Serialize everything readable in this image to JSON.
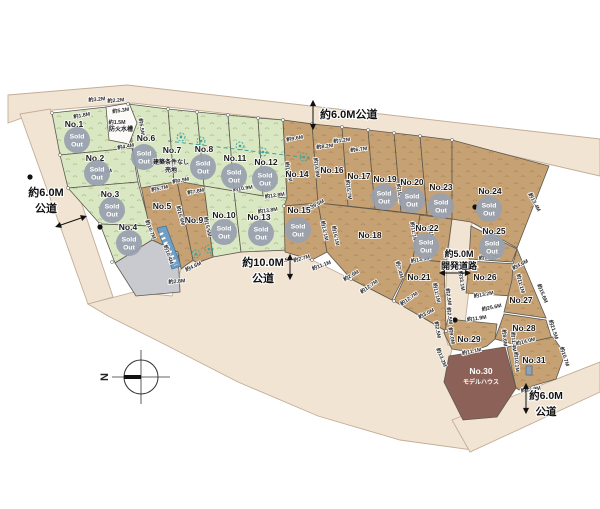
{
  "colors": {
    "road": "#f2e4d3",
    "road_stroke": "#c3ad96",
    "green": "#d9e7c2",
    "green_mark": "#a4bd81",
    "brown": "#c6a173",
    "brown_mark": "#a8854e",
    "maroon": "#8c6157",
    "gray": "#c9cad0",
    "white_lot": "#fbfaf6",
    "plot_stroke": "#5d594f",
    "badge": "#98a1af",
    "badge_text": "#ffffff",
    "dim_text": "#2a2a2a",
    "label_text": "#1a1a1a",
    "tree": "#3aa69f",
    "strip": "#6f9fc4",
    "strip_stroke": "#46749c",
    "road_label_text": "#111111",
    "dash_line": "#2f9e97"
  },
  "sold_badge": {
    "line1": "Sold",
    "line2": "Out"
  },
  "roads": [
    {
      "name": "top-road",
      "pts": "8,95 127,85 600,139 600,176 452,142 283,120 133,103 42,111 8,123"
    },
    {
      "name": "left-road",
      "pts": "20,114 50,109 113,297 88,304"
    },
    {
      "name": "bottom-curved-road",
      "pts": "88,304 134,292 172,296 182,266 198,259 241,252 288,250 312,260 351,279 394,301 446,331 444,333 452,349 444,382 463,420 472,450 400,440 318,416 238,382 160,342 108,316"
    },
    {
      "name": "bottom-right-road",
      "pts": "452,420 600,362 600,392 470,452"
    },
    {
      "name": "development-road",
      "pts": "452,219 472,222 469,290 462,348 448,345 444,331 447,262"
    }
  ],
  "plots": [
    {
      "id": "No.1",
      "pts": "52,113 125,105 132,148 60,155",
      "fill": "green",
      "label": {
        "t": "No.1",
        "x": 74,
        "y": 127
      },
      "badge": {
        "x": 77,
        "y": 140
      }
    },
    {
      "id": "No.2",
      "pts": "60,155 132,148 138,182 68,188",
      "fill": "green",
      "label": {
        "t": "No.2",
        "x": 95,
        "y": 161
      },
      "badge": {
        "x": 97,
        "y": 173
      }
    },
    {
      "id": "No.3",
      "pts": "68,188 138,182 150,226 100,224",
      "fill": "green",
      "label": {
        "t": "No.3",
        "x": 110,
        "y": 197
      },
      "badge": {
        "x": 112,
        "y": 210
      }
    },
    {
      "id": "No.4",
      "pts": "100,224 150,226 152,240 115,263",
      "fill": "green",
      "label": {
        "t": "No.4",
        "x": 128,
        "y": 230
      },
      "badge": {
        "x": 129,
        "y": 243
      }
    },
    {
      "id": "No.5",
      "pts": "141,186 177,181 193,260 181,269 178,252 152,240",
      "fill": "brown",
      "label": {
        "t": "No.5",
        "x": 162,
        "y": 209
      }
    },
    {
      "id": "No.6",
      "pts": "128,104 168,109 174,182 141,188 133,150",
      "fill": "green",
      "label": {
        "t": "No.6",
        "x": 146,
        "y": 141
      },
      "badge": {
        "x": 144,
        "y": 157
      }
    },
    {
      "id": "No.7",
      "pts": "168,109 197,112 204,186 174,182",
      "fill": "green",
      "label": {
        "t": "No.7",
        "x": 172,
        "y": 153
      },
      "sub": [
        {
          "t": "建築条件なし",
          "x": 171,
          "y": 164
        },
        {
          "t": "売地",
          "x": 171,
          "y": 172
        }
      ]
    },
    {
      "id": "No.8",
      "pts": "197,112 228,115 234,191 204,186",
      "fill": "green",
      "label": {
        "t": "No.8",
        "x": 204,
        "y": 152
      },
      "badge": {
        "x": 203,
        "y": 167
      }
    },
    {
      "id": "No.9",
      "pts": "177,181 204,186 213,257 197,263 193,260",
      "fill": "brown",
      "label": {
        "t": "No.9",
        "x": 194,
        "y": 223
      }
    },
    {
      "id": "No.10",
      "pts": "204,186 234,191 241,252 213,257",
      "fill": "green",
      "label": {
        "t": "No.10",
        "x": 224,
        "y": 218
      },
      "badge": {
        "x": 224,
        "y": 232
      }
    },
    {
      "id": "No.11",
      "pts": "228,115 258,118 263,196 234,191",
      "fill": "green",
      "label": {
        "t": "No.11",
        "x": 235,
        "y": 161
      },
      "badge": {
        "x": 234,
        "y": 176
      }
    },
    {
      "id": "No.12",
      "pts": "258,118 283,120 287,198 263,196",
      "fill": "green",
      "label": {
        "t": "No.12",
        "x": 266,
        "y": 165
      },
      "badge": {
        "x": 265,
        "y": 179
      }
    },
    {
      "id": "No.13",
      "pts": "234,191 263,196 287,198 288,250 241,252",
      "fill": "green",
      "label": {
        "t": "No.13",
        "x": 259,
        "y": 220
      },
      "badge": {
        "x": 261,
        "y": 233
      }
    },
    {
      "id": "No.14",
      "pts": "283,120 312,124 318,203 284,206 287,198",
      "fill": "brown",
      "label": {
        "t": "No.14",
        "x": 297,
        "y": 177
      }
    },
    {
      "id": "No.15",
      "pts": "284,206 318,203 327,252 312,260 285,252",
      "fill": "brown",
      "label": {
        "t": "No.15",
        "x": 299,
        "y": 213
      },
      "badge": {
        "x": 298,
        "y": 230
      }
    },
    {
      "id": "No.16",
      "pts": "312,124 342,127 348,206 318,203",
      "fill": "brown",
      "label": {
        "t": "No.16",
        "x": 332,
        "y": 173
      }
    },
    {
      "id": "No.17",
      "pts": "342,127 368,130 375,209 348,206",
      "fill": "brown",
      "label": {
        "t": "No.17",
        "x": 359,
        "y": 179
      }
    },
    {
      "id": "No.18",
      "pts": "318,203 424,215 413,259 392,300 351,279 327,252",
      "fill": "brown",
      "label": {
        "t": "No.18",
        "x": 370,
        "y": 238
      }
    },
    {
      "id": "No.19",
      "pts": "368,130 394,133 401,212 375,209",
      "fill": "brown",
      "label": {
        "t": "No.19",
        "x": 385,
        "y": 182
      },
      "badge": {
        "x": 384,
        "y": 197
      }
    },
    {
      "id": "No.20",
      "pts": "394,133 420,136 427,215 401,212",
      "fill": "brown",
      "label": {
        "t": "No.20",
        "x": 412,
        "y": 185
      },
      "badge": {
        "x": 412,
        "y": 200
      }
    },
    {
      "id": "No.21",
      "pts": "413,259 444,262 446,331 394,301",
      "fill": "brown",
      "label": {
        "t": "No.21",
        "x": 419,
        "y": 280
      }
    },
    {
      "id": "No.22",
      "pts": "420,215 452,219 446,262 413,259",
      "fill": "brown",
      "label": {
        "t": "No.22",
        "x": 427,
        "y": 231
      },
      "badge": {
        "x": 426,
        "y": 246
      }
    },
    {
      "id": "No.23",
      "pts": "420,136 452,140 452,219 427,215",
      "fill": "brown",
      "label": {
        "t": "No.23",
        "x": 441,
        "y": 190
      },
      "badge": {
        "x": 441,
        "y": 206
      }
    },
    {
      "id": "No.24",
      "pts": "452,140 549,166 517,248 471,222 452,219",
      "fill": "brown",
      "label": {
        "t": "No.24",
        "x": 490,
        "y": 194
      },
      "badge": {
        "x": 489,
        "y": 209
      }
    },
    {
      "id": "No.25",
      "pts": "471,226 517,249 512,262 469,259",
      "fill": "brown",
      "label": {
        "t": "No.25",
        "x": 494,
        "y": 234
      },
      "badge": {
        "x": 492,
        "y": 247
      }
    },
    {
      "id": "No.26",
      "pts": "469,261 517,264 512,296 466,293",
      "fill": "brown",
      "label": {
        "t": "No.26",
        "x": 485,
        "y": 280
      }
    },
    {
      "id": "No.27",
      "pts": "517,249 546,318 504,312 512,280 513,264",
      "fill": "brown",
      "label": {
        "t": "No.27",
        "x": 521,
        "y": 303
      }
    },
    {
      "id": "No.28",
      "pts": "504,314 546,320 556,352 516,345 495,339",
      "fill": "brown",
      "label": {
        "t": "No.28",
        "x": 524,
        "y": 331
      }
    },
    {
      "id": "No.29",
      "pts": "448,319 497,324 495,339 487,346 470,352 452,349 444,333",
      "fill": "brown",
      "label": {
        "t": "No.29",
        "x": 469,
        "y": 342
      }
    },
    {
      "id": "No.30",
      "pts": "449,356 505,347 516,388 497,417 463,420 444,382",
      "fill": "maroon",
      "label": {
        "t": "No.30",
        "x": 481,
        "y": 374,
        "white": true
      },
      "sub": [
        {
          "t": "モデルハウス",
          "x": 481,
          "y": 384,
          "white": true
        }
      ]
    },
    {
      "id": "No.31",
      "pts": "507,347 553,337 565,354 556,379 519,390 516,388",
      "fill": "brown",
      "label": {
        "t": "No.31",
        "x": 534,
        "y": 363
      }
    },
    {
      "id": "gray-lot",
      "pts": "115,263 152,240 178,252 180,292 136,296",
      "fill": "gray"
    },
    {
      "id": "fire-cistern",
      "pts": "106,107 129,103 137,123 129,144 109,140",
      "fill": "white_lot",
      "sub": [
        {
          "t": "防火水槽",
          "x": 121,
          "y": 131
        }
      ]
    }
  ],
  "dimensions": [
    {
      "t": "約3.2M",
      "x": 97,
      "y": 101,
      "r": -5
    },
    {
      "t": "約2.2M",
      "x": 116,
      "y": 102,
      "r": -5
    },
    {
      "t": "約1.8M",
      "x": 82,
      "y": 117,
      "r": -10
    },
    {
      "t": "約5.3M",
      "x": 121,
      "y": 112,
      "r": -8
    },
    {
      "t": "約1.5M",
      "x": 117,
      "y": 124,
      "r": 0
    },
    {
      "t": "約4.4M",
      "x": 126,
      "y": 148,
      "r": -10
    },
    {
      "t": "約5.5M",
      "x": 140,
      "y": 127,
      "r": 82
    },
    {
      "t": "約4.9M",
      "x": 104,
      "y": 174,
      "r": -14
    },
    {
      "t": "約5.7M",
      "x": 160,
      "y": 190,
      "r": -12
    },
    {
      "t": "約7.8M",
      "x": 196,
      "y": 193,
      "r": -10
    },
    {
      "t": "約0.9M",
      "x": 181,
      "y": 182,
      "r": -10
    },
    {
      "t": "約10.9M",
      "x": 243,
      "y": 190,
      "r": -8
    },
    {
      "t": "約12.8M",
      "x": 275,
      "y": 197,
      "r": -8
    },
    {
      "t": "約13.8M",
      "x": 268,
      "y": 212,
      "r": -8
    },
    {
      "t": "約15.9M",
      "x": 179,
      "y": 216,
      "r": 75
    },
    {
      "t": "約15.5M",
      "x": 206,
      "y": 227,
      "r": 78
    },
    {
      "t": "約10.7M",
      "x": 149,
      "y": 230,
      "r": 68
    },
    {
      "t": "約10.4M",
      "x": 167,
      "y": 255,
      "r": 70
    },
    {
      "t": "約4.6M",
      "x": 194,
      "y": 268,
      "r": -25
    },
    {
      "t": "約2.8M",
      "x": 177,
      "y": 283,
      "r": -5
    },
    {
      "t": "約9.6M",
      "x": 295,
      "y": 140,
      "r": -10
    },
    {
      "t": "約14.8M",
      "x": 287,
      "y": 172,
      "r": 78
    },
    {
      "t": "約14.8M",
      "x": 315,
      "y": 168,
      "r": 82
    },
    {
      "t": "約9.5M",
      "x": 317,
      "y": 206,
      "r": -28
    },
    {
      "t": "約13.1M",
      "x": 323,
      "y": 231,
      "r": 78
    },
    {
      "t": "約16.1M",
      "x": 334,
      "y": 236,
      "r": 78
    },
    {
      "t": "約8.2M",
      "x": 325,
      "y": 148,
      "r": -7
    },
    {
      "t": "約1.2M",
      "x": 342,
      "y": 142,
      "r": -7
    },
    {
      "t": "約6.7M",
      "x": 359,
      "y": 151,
      "r": -7
    },
    {
      "t": "約15.7M",
      "x": 347,
      "y": 190,
      "r": 82
    },
    {
      "t": "約15.1M",
      "x": 398,
      "y": 194,
      "r": 82
    },
    {
      "t": "約11.1M",
      "x": 412,
      "y": 232,
      "r": 80
    },
    {
      "t": "約15.4M",
      "x": 430,
      "y": 236,
      "r": 80
    },
    {
      "t": "約13.5M",
      "x": 421,
      "y": 261,
      "r": -10
    },
    {
      "t": "約7.4M",
      "x": 398,
      "y": 270,
      "r": 75
    },
    {
      "t": "約11.1M",
      "x": 435,
      "y": 293,
      "r": 78
    },
    {
      "t": "約12.7M",
      "x": 410,
      "y": 300,
      "r": -35
    },
    {
      "t": "約3.0M",
      "x": 427,
      "y": 315,
      "r": -28
    },
    {
      "t": "約2.5M",
      "x": 284,
      "y": 262,
      "r": -12
    },
    {
      "t": "約2.7M",
      "x": 302,
      "y": 260,
      "r": -15
    },
    {
      "t": "約11.1M",
      "x": 322,
      "y": 267,
      "r": -20
    },
    {
      "t": "約2.6M",
      "x": 352,
      "y": 277,
      "r": -30
    },
    {
      "t": "約12.7M",
      "x": 370,
      "y": 288,
      "r": -35
    },
    {
      "t": "約2.5M",
      "x": 447,
      "y": 297,
      "r": 82
    },
    {
      "t": "約2.5M",
      "x": 448,
      "y": 316,
      "r": 82
    },
    {
      "t": "約9.0M",
      "x": 450,
      "y": 336,
      "r": 80
    },
    {
      "t": "約33.1M",
      "x": 460,
      "y": 281,
      "r": 82
    },
    {
      "t": "約13.2M",
      "x": 489,
      "y": 259,
      "r": -6
    },
    {
      "t": "約13.2M",
      "x": 484,
      "y": 296,
      "r": -10
    },
    {
      "t": "約25.6M",
      "x": 492,
      "y": 309,
      "r": -12
    },
    {
      "t": "約11.9M",
      "x": 477,
      "y": 320,
      "r": -8
    },
    {
      "t": "約4.6M",
      "x": 521,
      "y": 266,
      "r": -28
    },
    {
      "t": "約11.1M",
      "x": 519,
      "y": 284,
      "r": 75
    },
    {
      "t": "約15.6M",
      "x": 541,
      "y": 294,
      "r": 68
    },
    {
      "t": "約13.4M",
      "x": 533,
      "y": 203,
      "r": 62
    },
    {
      "t": "約21.5M",
      "x": 552,
      "y": 330,
      "r": 72
    },
    {
      "t": "約14.0M",
      "x": 526,
      "y": 343,
      "r": -14
    },
    {
      "t": "約10.7M",
      "x": 563,
      "y": 357,
      "r": 72
    },
    {
      "t": "約9.6M",
      "x": 503,
      "y": 338,
      "r": 85
    },
    {
      "t": "約11.4M",
      "x": 512,
      "y": 342,
      "r": 85
    },
    {
      "t": "約10.1M",
      "x": 515,
      "y": 362,
      "r": 85
    },
    {
      "t": "約11.1M",
      "x": 472,
      "y": 353,
      "r": -12
    },
    {
      "t": "約13.2M",
      "x": 440,
      "y": 358,
      "r": 68
    },
    {
      "t": "約2.5M",
      "x": 436,
      "y": 330,
      "r": 80
    },
    {
      "t": "約13.9M",
      "x": 531,
      "y": 391,
      "r": -8
    }
  ],
  "road_labels": [
    {
      "name": "road-label-west",
      "lines": [
        "約6.0M",
        "公道"
      ],
      "x": 46,
      "y": 196,
      "lh": 16,
      "size": 11,
      "anchor": "middle"
    },
    {
      "name": "road-label-north",
      "lines": [
        "約6.0M公道"
      ],
      "x": 320,
      "y": 118,
      "lh": 14,
      "size": 11,
      "anchor": "start"
    },
    {
      "name": "road-label-south",
      "lines": [
        "約10.0M",
        "公道"
      ],
      "x": 263,
      "y": 266,
      "lh": 16,
      "size": 11,
      "anchor": "middle"
    },
    {
      "name": "road-label-development",
      "lines": [
        "約5.0M",
        "開発道路"
      ],
      "x": 459,
      "y": 257,
      "lh": 12,
      "size": 9,
      "anchor": "middle"
    },
    {
      "name": "road-label-southeast",
      "lines": [
        "約6.0M",
        "公道"
      ],
      "x": 546,
      "y": 399,
      "lh": 16,
      "size": 10.5,
      "anchor": "middle"
    }
  ],
  "arrows": [
    {
      "x1": 58,
      "y1": 226,
      "x2": 84,
      "y2": 217
    },
    {
      "x1": 313,
      "y1": 103,
      "x2": 313,
      "y2": 127
    },
    {
      "x1": 290,
      "y1": 257,
      "x2": 290,
      "y2": 277
    },
    {
      "x1": 442,
      "y1": 273,
      "x2": 468,
      "y2": 273
    },
    {
      "x1": 526,
      "y1": 386,
      "x2": 526,
      "y2": 411
    }
  ],
  "trees": [
    [
      181,
      137
    ],
    [
      201,
      141
    ],
    [
      240,
      146
    ],
    [
      263,
      152
    ],
    [
      304,
      157
    ],
    [
      196,
      254
    ],
    [
      209,
      249
    ]
  ],
  "dots": [
    [
      30,
      177
    ],
    [
      100,
      227
    ],
    [
      475,
      207
    ],
    [
      455,
      320
    ]
  ],
  "vertices": [
    [
      52,
      113
    ],
    [
      60,
      155
    ],
    [
      68,
      188
    ],
    [
      100,
      224
    ],
    [
      112,
      262
    ],
    [
      128,
      104
    ],
    [
      168,
      109
    ],
    [
      197,
      112
    ],
    [
      228,
      115
    ],
    [
      258,
      118
    ],
    [
      283,
      120
    ],
    [
      312,
      124
    ],
    [
      342,
      127
    ],
    [
      368,
      130
    ],
    [
      394,
      133
    ],
    [
      420,
      136
    ],
    [
      452,
      140
    ],
    [
      284,
      206
    ],
    [
      312,
      260
    ],
    [
      351,
      279
    ],
    [
      394,
      301
    ],
    [
      446,
      331
    ]
  ],
  "dash_line": {
    "x1": 168,
    "y1": 141,
    "x2": 310,
    "y2": 158
  },
  "blue_strip": {
    "pts": "157,228 166,226 181,266 172,269"
  },
  "shed_icon": {
    "x": 526,
    "y": 366,
    "w": 6,
    "h": 9
  },
  "compass": {
    "cx": 141,
    "cy": 377,
    "r": 17,
    "label": "N"
  }
}
